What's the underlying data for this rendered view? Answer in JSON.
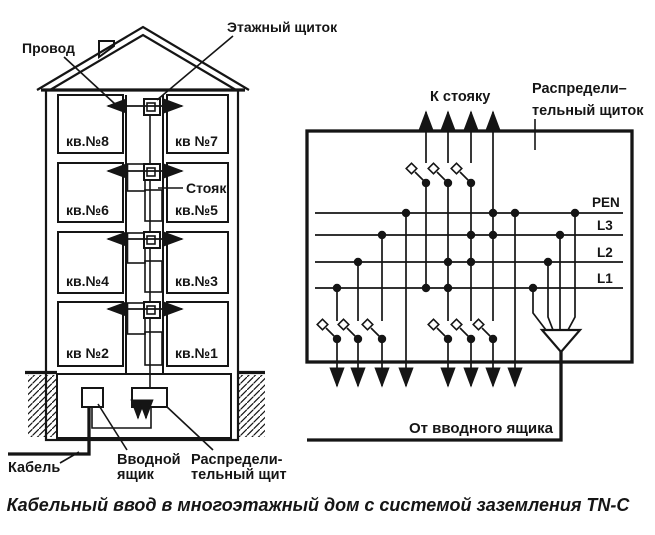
{
  "caption": "Кабельный ввод в многоэтажный дом с системой заземления TN-C",
  "colors": {
    "ink": "#151515",
    "paper": "#ffffff"
  },
  "building": {
    "wire_label": "Провод",
    "floor_panel_label": "Этажный щиток",
    "riser_label": "Стояк",
    "cable_label": "Кабель",
    "input_box_label_line1": "Вводной",
    "input_box_label_line2": "ящик",
    "dist_board_label_line1": "Распредели-",
    "dist_board_label_line2": "тельный щит",
    "apartments": [
      "кв.№8",
      "кв №7",
      "кв.№6",
      "кв.№5",
      "кв.№4",
      "кв.№3",
      "кв №2",
      "кв.№1"
    ]
  },
  "schematic": {
    "to_riser_label": "К стояку",
    "panel_label_line1": "Распредели–",
    "panel_label_line2": "тельный щиток",
    "from_input_label": "От вводного ящика",
    "buses": [
      "PEN",
      "L3",
      "L2",
      "L1"
    ]
  }
}
